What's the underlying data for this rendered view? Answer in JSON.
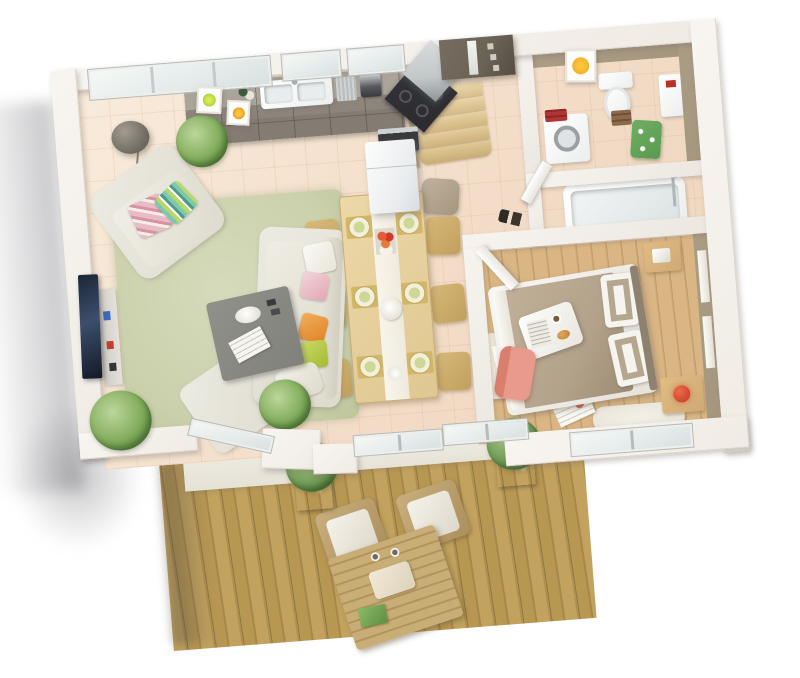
{
  "scene": {
    "title": "3D isometric floor plan of a one-bedroom apartment with terrace",
    "style": "architectural 3D render on white background, plan rotated slightly counter-clockwise",
    "rotation_deg": -4.5
  },
  "colors": {
    "wall": "#f0ebe4",
    "taupe": "#a5977e",
    "taupe_dark": "#8f8170",
    "tile": "#f5e3d2",
    "rug": "#cbd1ac",
    "wood_floor": "#d0a975",
    "wood_seam": "#bf9c6b",
    "deck": "#c2a25e",
    "stone": "#e6e2d6",
    "cream": "#dedbce",
    "table_gray": "#80817a",
    "tv": "#243048",
    "cushion_pink": "#e8b8c2",
    "cushion_orange": "#e8963e",
    "cushion_green": "#b2c84a",
    "cushion_teal": "#7ec8b0",
    "dining_wood": "#e4cd9b",
    "chair_wood": "#c9a969",
    "placemat": "#d2b66a",
    "kitchen_cab": "#8a8178",
    "kitchen_top": "#a9a39a",
    "steel": "#c2c7c8",
    "cooktop": "#2b2b2f",
    "door_dark": "#6b6256",
    "stair_wood": "#e4d0a6",
    "towel_red": "#b23434",
    "towel_green": "#5a9a50",
    "towel_brown": "#8a6a4a",
    "lamp_red": "#c23822",
    "chair_pink": "#e89a8c",
    "art_orange": "#f2a21c",
    "art_green": "#9ac31e",
    "bed_duvet": "#b3a28b",
    "plant": "#84ae5e",
    "planter": "#6a5a44"
  },
  "rooms": [
    {
      "id": "living",
      "label": "Living room: wall TV, media shelf, armchair with pink and striped cushions, cream sofa with pink/orange/green cushions, grey coffee table, ottoman, green rug, arc floor lamp, potted ferns"
    },
    {
      "id": "kitchen",
      "label": "Kitchen: grey-taupe counter run, double sink, coffee machine, corner cooktop with steel hood, oven, fridge, plant, kiwi and orange wall art"
    },
    {
      "id": "dining",
      "label": "Dining area: wood table with six chairs, six gold place settings, red flower vase, white centre bowl"
    },
    {
      "id": "entry",
      "label": "Entrance: dark front door with glass strip, quarter-turn wooden staircase, taupe pouf, pair of shoes"
    },
    {
      "id": "wc",
      "label": "WC / laundry: toilet, washing machine, red and green towels, orange-dot wall art"
    },
    {
      "id": "bathroom",
      "label": "Bathroom: bathtub with chrome shower column"
    },
    {
      "id": "bedroom",
      "label": "Bedroom: double bed with taupe duvet and breakfast tray, nightstands, red lamp, desk with salmon chair, taupe feature wall with white panels, wood floor"
    },
    {
      "id": "terrace",
      "label": "Terrace: golden wood decking, two wooden armchairs with white cushions, slatted low table, two planter boxes with shrubs"
    }
  ]
}
